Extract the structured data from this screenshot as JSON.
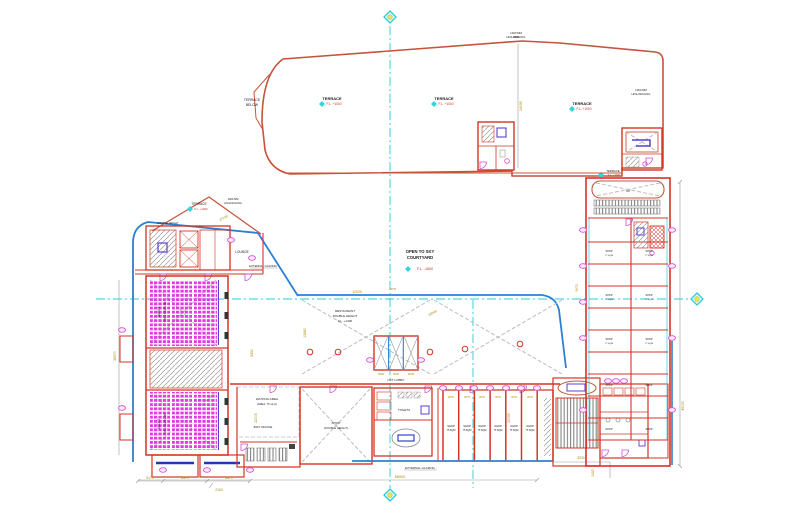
{
  "drawing": {
    "title": "floor-plan",
    "labels": {
      "terrace": "TERRACE",
      "fl_plus_1000": "F.L. +1000",
      "terrace_below_1": "TERRACE",
      "terrace_below_2": "BELOW",
      "railing_1": "1000 MM",
      "railing_2": "HIGH RAILING",
      "open_sky_1": "OPEN TO SKY",
      "open_sky_2": "COURTYARD",
      "courtyard_level": "F.L. -1800",
      "restaurant_1": "RESTAURANT",
      "restaurant_2": "DOUBLE HEIGHT",
      "restaurant_3": "F.L. +1400",
      "waiting_1": "WAITING AREA",
      "waiting_2": "(AREA: 76 sq.m)",
      "box_office": "BOX OFFICE",
      "lift_lobby": "LIFT LOBBY",
      "external_glazing": "EXTERNAL GLAZING",
      "lounge": "LOUNGE",
      "double_height": "DOUBLE HEIGHT",
      "audi1_name": "AUDI 1",
      "audi2_name": "AUDI 2",
      "audi_seats": "TOTAL SEATS 180",
      "shop_line1": "SHOP",
      "shop_line2": "75 SQM",
      "unit_line1": "SHOP",
      "unit_line2": "77 SQM",
      "shop_dh_1": "SHOP",
      "shop_dh_2": "(DOUBLE HEIGHT)",
      "toilets": "TOILETS",
      "up": "UP"
    },
    "dims": {
      "d68000": "68000",
      "d8230": "8230",
      "d2400": "2400",
      "d5175": "5175",
      "d8370": "8370",
      "d2100": "2100",
      "d49150": "49150",
      "d22055": "22055",
      "d22005": "22005",
      "d12025": "12025",
      "d15640": "15640",
      "d13680": "13680",
      "d27130": "27130",
      "d24095": "24095",
      "d3075": "3075",
      "d2500": "2500",
      "d5450": "5450",
      "d5970": "5970",
      "d36570": "36570"
    },
    "colors": {
      "wall_red": "#d43425",
      "terrace_red": "#c4543a",
      "glazing_blue": "#2d7fd2",
      "centerline_cyan": "#27ccd8",
      "dimension_olive": "#a68b00",
      "seat_magenta": "#e23ae2",
      "detail_purple": "#5b3fd0",
      "hatch_gray": "#9a9a9a",
      "marker_yellow": "#e6e65a"
    }
  }
}
